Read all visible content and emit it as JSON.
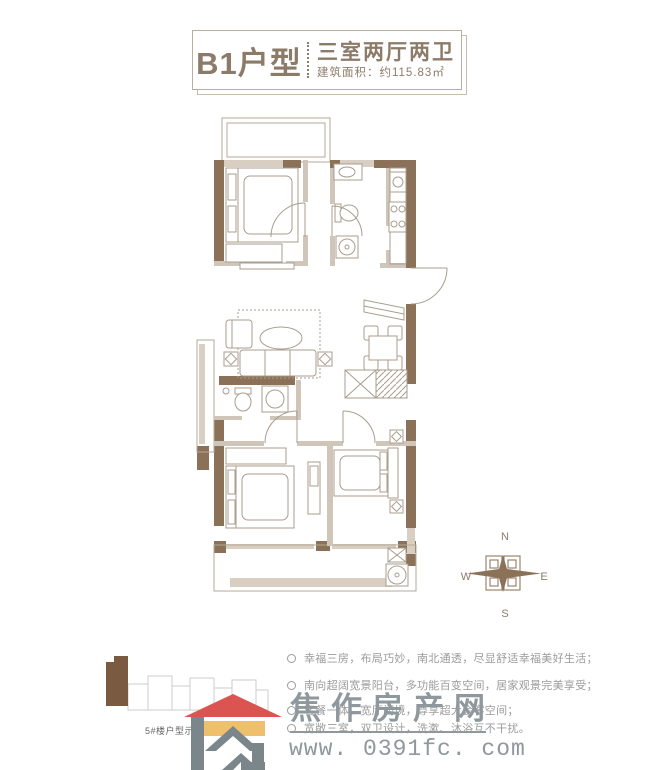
{
  "header": {
    "unit_name": "B1户型",
    "unit_type": "三室两厅两卫",
    "area": "建筑面积：约115.83㎡"
  },
  "compass": {
    "north": "N",
    "south": "S",
    "east": "E",
    "west": "W"
  },
  "site_plan": {
    "caption": "5#楼户型示意图"
  },
  "features": [
    "幸福三房，布局巧妙，南北通透，尽显舒适幸福美好生活；",
    "南向超阔宽景阳台，多功能百变空间，居家观景完美享受；",
    "客餐一体，宽厅阔境，尊享超大会客空间；",
    "宽敞三室，双卫设计，洗漱、沐浴互不干扰。"
  ],
  "watermark": {
    "site_name": "焦作房产网",
    "site_url": "www. 0391fc. com"
  },
  "colors": {
    "wall_brown": "#8b7157",
    "wall_light": "#d8cec1",
    "title_brown": "#8c7b68",
    "logo_red": "#dc5451",
    "logo_yellow": "#eec06d",
    "logo_gray": "#7b868b",
    "watermark_gray": "#8e989d",
    "feature_gray": "#9b9b9b"
  }
}
